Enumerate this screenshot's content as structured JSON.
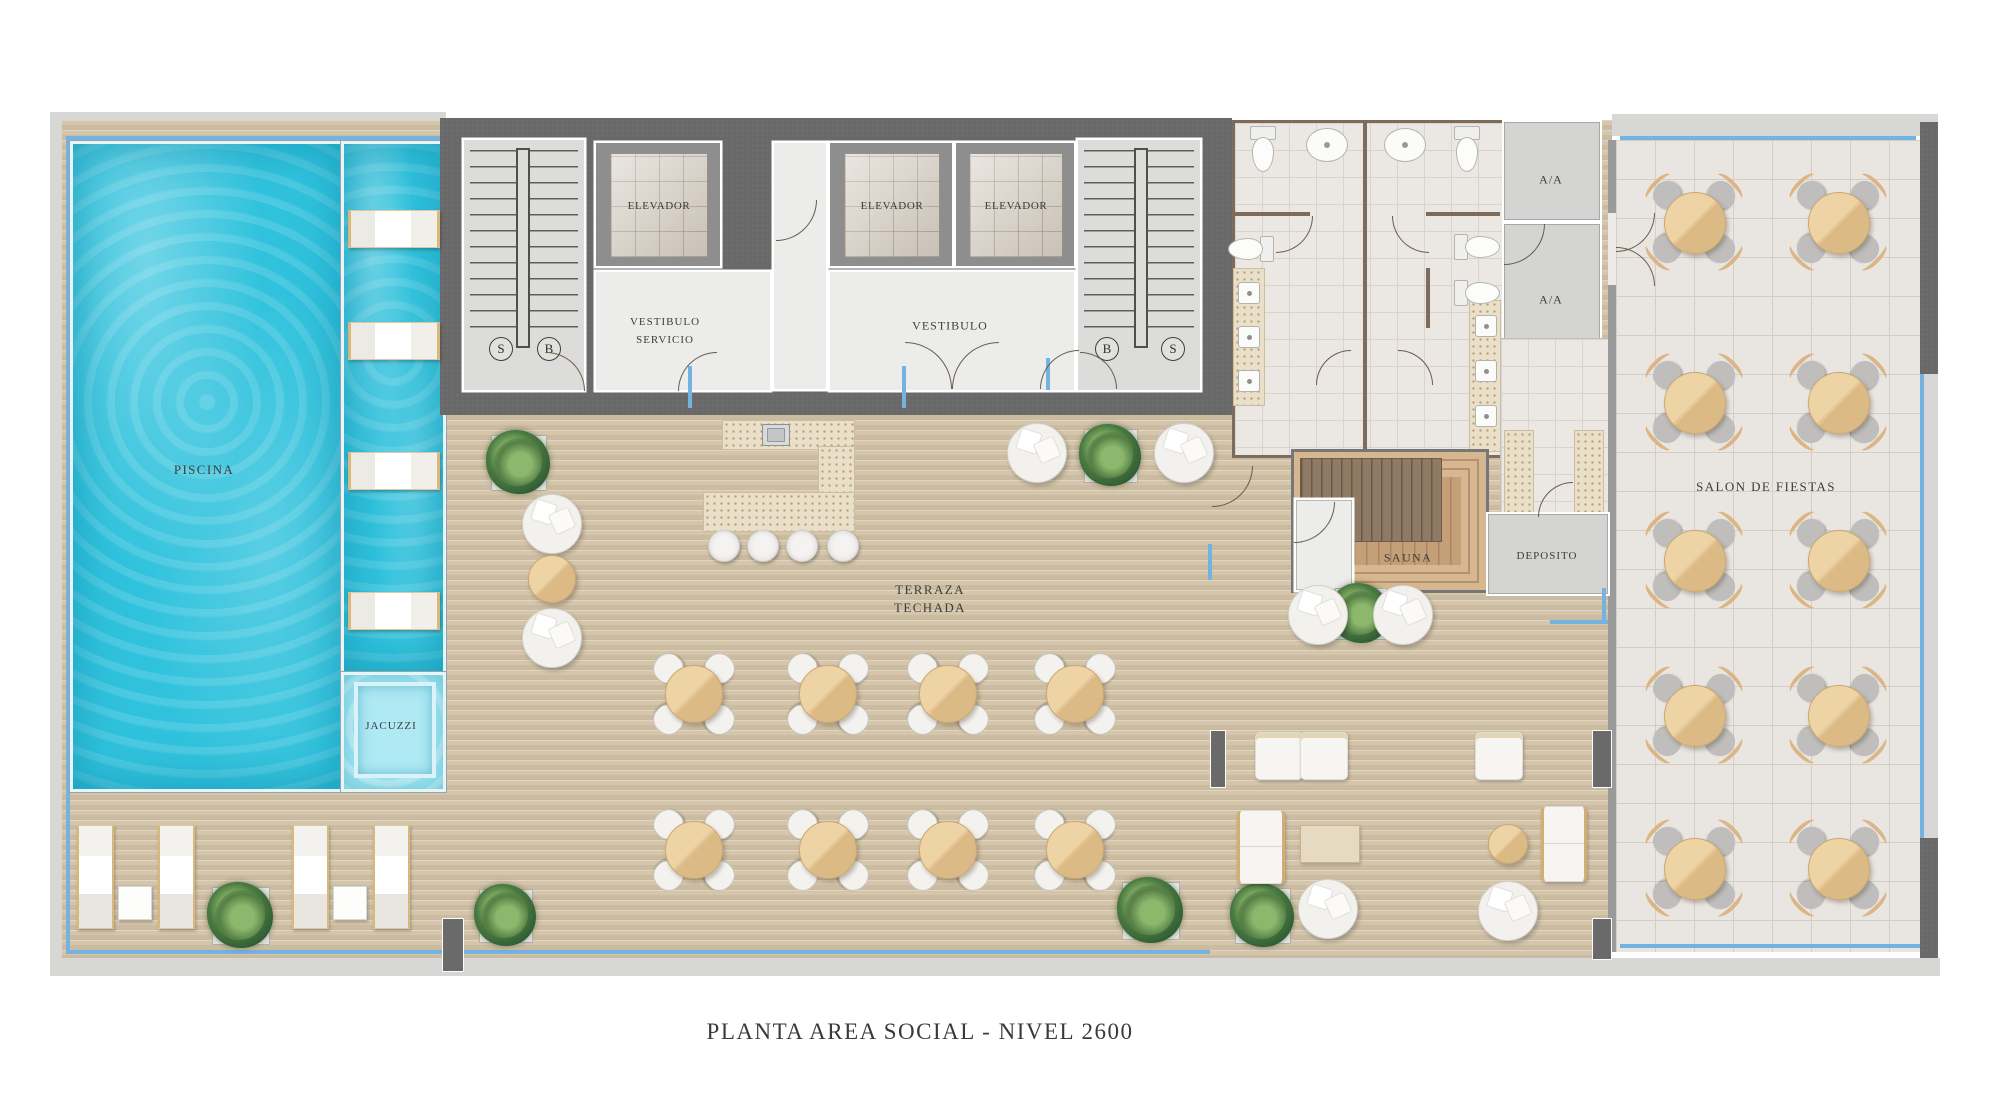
{
  "title": "PLANTA AREA SOCIAL - NIVEL 2600",
  "labels": {
    "piscina": "PISCINA",
    "jacuzzi": "JACUZZI",
    "terraza_l1": "TERRAZA",
    "terraza_l2": "TECHADA",
    "vest_serv_l1": "VESTIBULO",
    "vest_serv_l2": "SERVICIO",
    "vestibulo": "VESTIBULO",
    "elevador": "ELEVADOR",
    "sauna": "SAUNA",
    "deposito": "DEPOSITO",
    "salon": "SALON DE FIESTAS",
    "aa": "A/A",
    "stair_s": "S",
    "stair_b": "B"
  },
  "counts": {
    "elevators": 3,
    "stairs": 2,
    "salon_tables": 10,
    "terraza_tables": 8,
    "pool_loungers": 4,
    "sun_loungers": 4,
    "bar_stools": 4
  },
  "colors": {
    "pool_water": "#30c2dd",
    "jacuzzi_water": "#9fe6f2",
    "deck_wood": "#d4c5ab",
    "core_wall": "#696969",
    "bath_wall": "#7d6c5b",
    "tile_floor": "#ebe7e2",
    "salon_floor": "#e9e5e1",
    "speckled_stone": "#eadfc8",
    "sauna_wood": "#c49f78",
    "sauna_bench": "#8f7a66",
    "glass_blue": "#74b2df",
    "table_wood": "#e2bd8a",
    "label_text": "#3d3d3d"
  }
}
